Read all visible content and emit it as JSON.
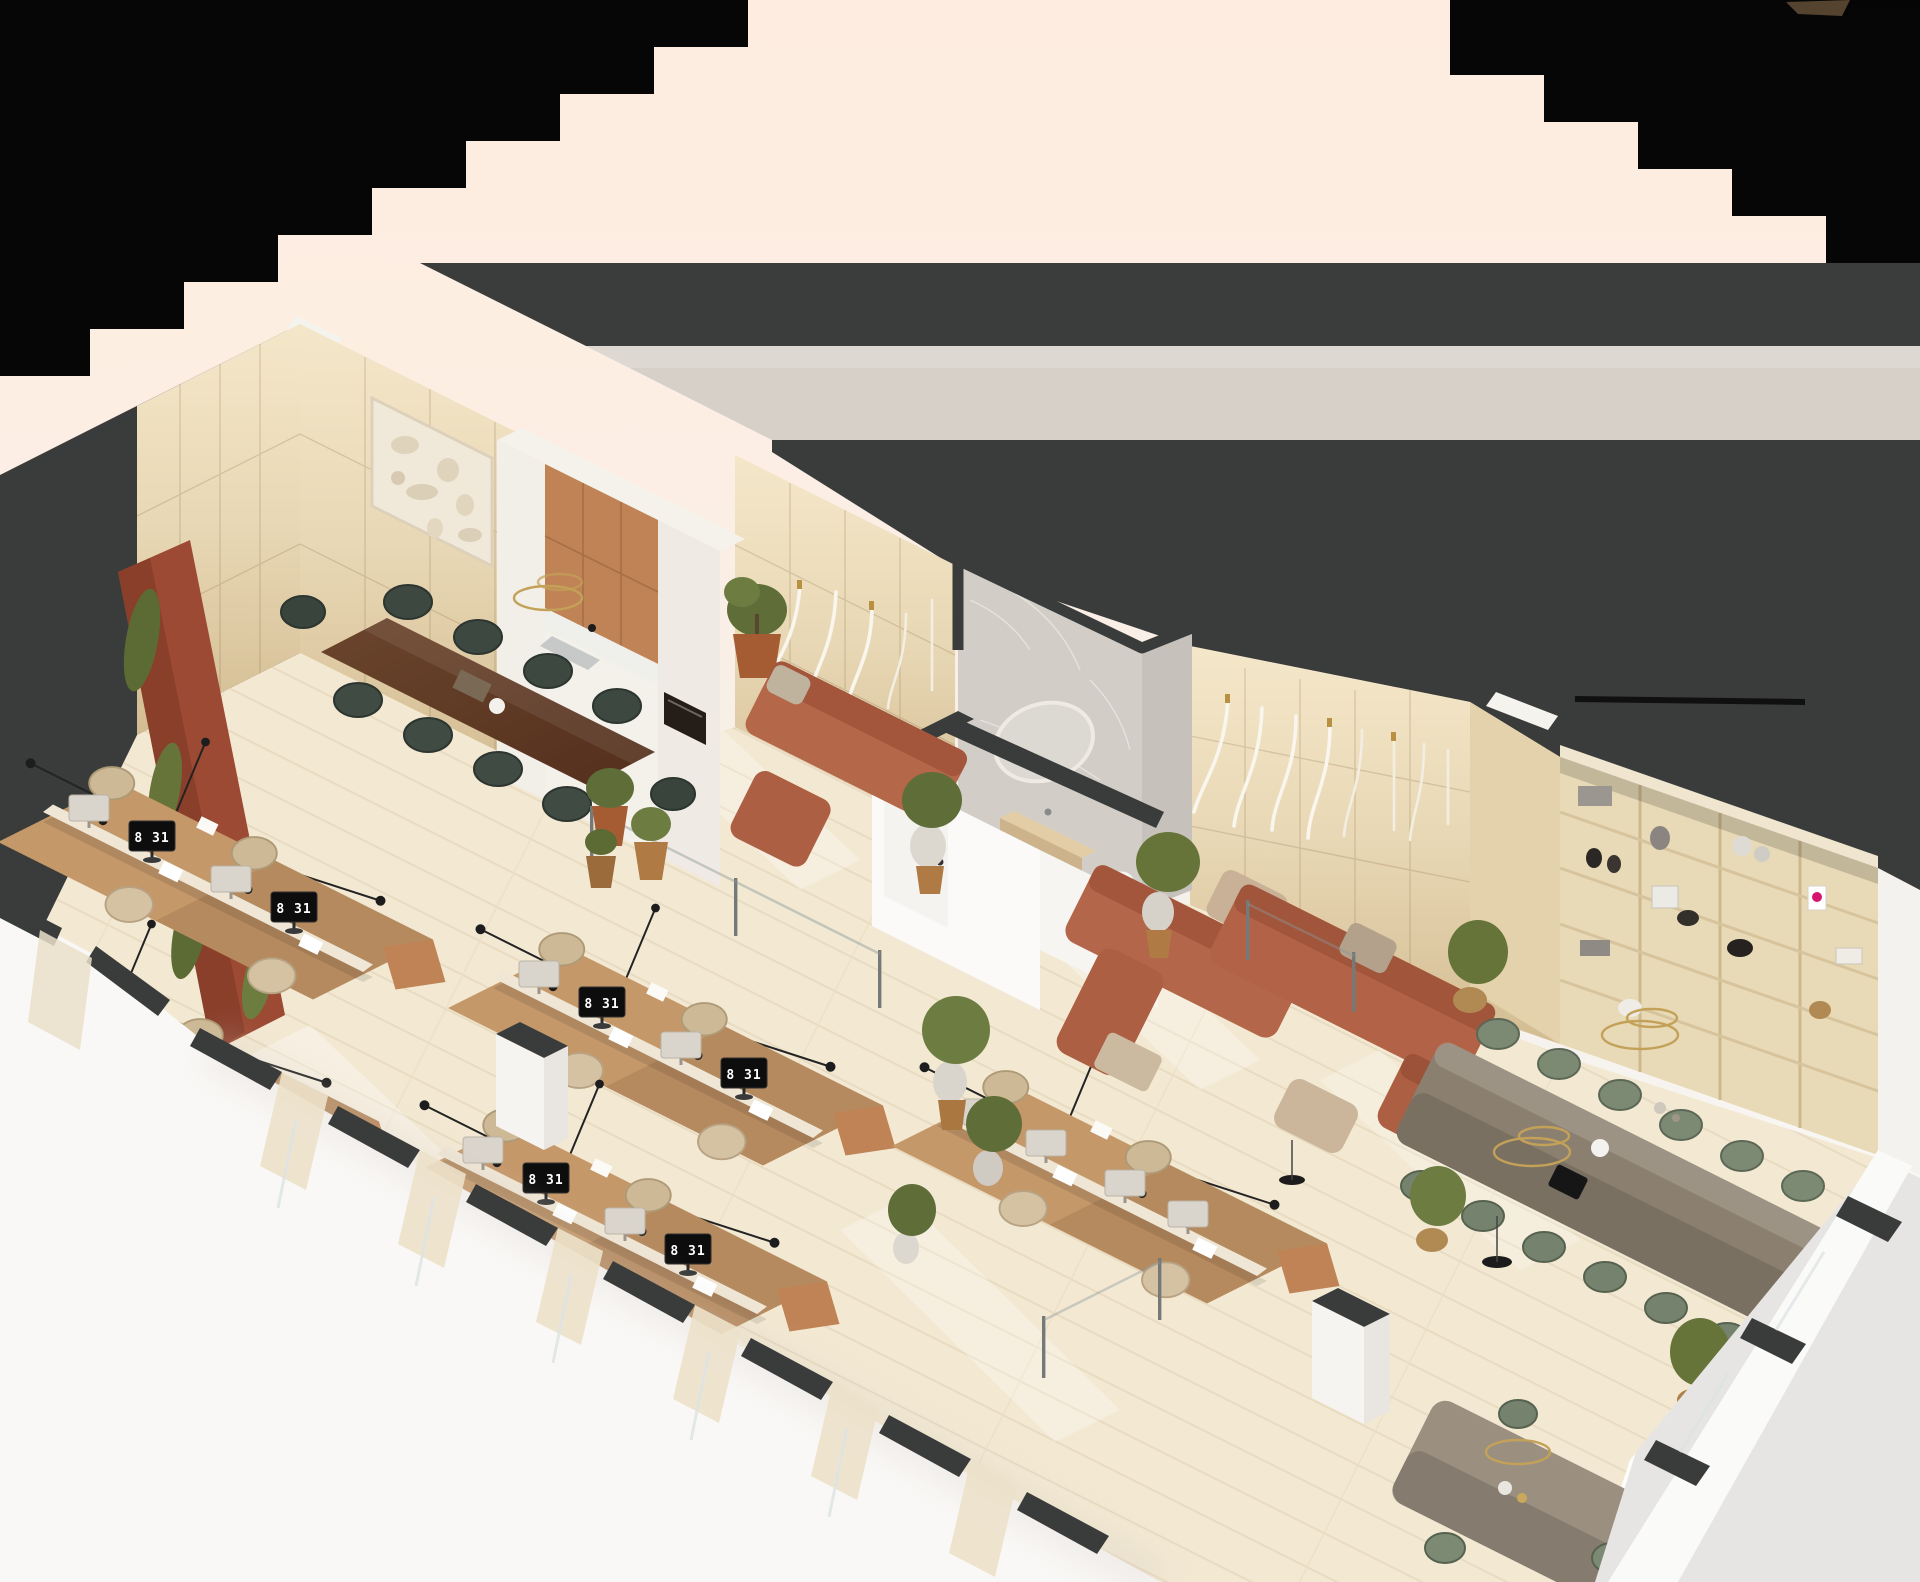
{
  "meta": {
    "description": "Isometric 3D render of a modern office floor plan on a peach backdrop",
    "canvas": {
      "width": 1920,
      "height": 1582
    },
    "projection": "isometric cutaway, walls sectioned dark gray, black masked corners"
  },
  "clock_time": "8 31",
  "palette": {
    "peach-bg": "#fdecdf",
    "cream-bg": "#f6f1ec",
    "corner-black": "#060606",
    "cut-wall-dark": "#3b3d3c",
    "band-beige": "#d7d0c8",
    "wood-wall": "#ead9b6",
    "floor": "#f3e9d3",
    "floor-plank": "#e6d8bd",
    "rust-wall": "#9c4a33",
    "plant-green": "#66743a",
    "kitchen-terracotta": "#c08356",
    "sofa-terracotta": "#b26243",
    "meeting-chair-green": "#3d4840",
    "boardroom-chair-sage": "#7c8973",
    "desk-wood": "#c5986a",
    "desk-chair-tan": "#d5c2a2",
    "monitor-black": "#0d0d0d",
    "marble": "#d2cec7",
    "shelf-wood": "#e8dab6",
    "brass": "#c3a158",
    "white-wall": "#fbfaf8",
    "exterior-ground": "#e6e5e3",
    "accent-magenta": "#d6156e"
  },
  "scene": {
    "rooms": [
      {
        "name": "meeting-room",
        "items": "walnut table, 10 dark-green velvet chairs, relief art panel, ring pendant, potted tree"
      },
      {
        "name": "kitchenette",
        "items": "terracotta cabinet fronts, terrazzo splash, sink, built-in oven"
      },
      {
        "name": "lounge-one",
        "items": "terracotta sofa, cascading tube chandelier"
      },
      {
        "name": "washroom",
        "items": "marble walls, backlit oval mirror, oak vanity, toilet"
      },
      {
        "name": "open-office",
        "items": "5 desk pods, 18 workstations, monitor clocks reading 8 31, wire truss lights, glass partitions"
      },
      {
        "name": "lounge-two",
        "items": "3 modular terracotta sofas, beige pouf and ottoman, planters"
      },
      {
        "name": "library-wall",
        "items": "oak shelving 4x5 with vases, books, baskets, magenta art book"
      },
      {
        "name": "boardroom",
        "items": "long table, 12 sage task chairs, 2 brass ring pendants"
      },
      {
        "name": "dining-nook",
        "items": "small table, sage chairs, brass ring pendant"
      }
    ],
    "monitor_clock_count": 8
  }
}
